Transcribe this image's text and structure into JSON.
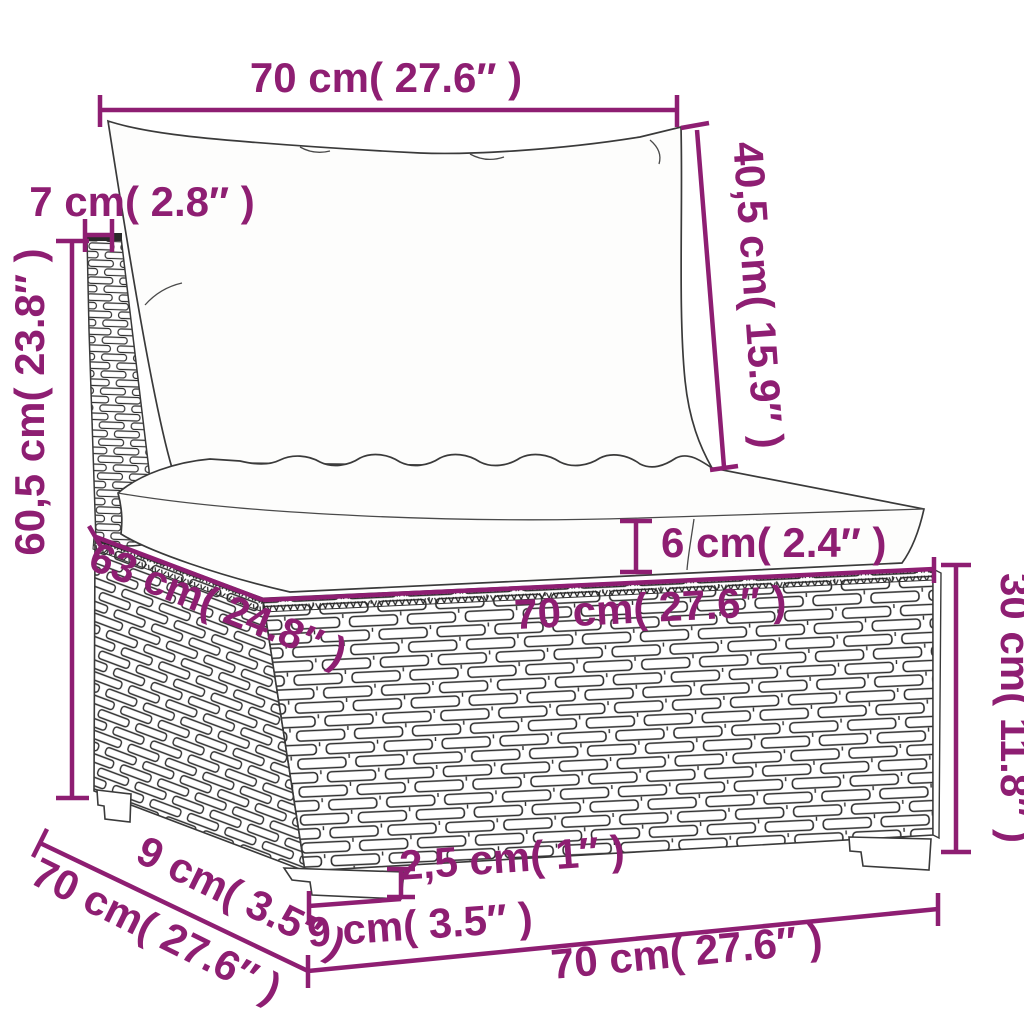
{
  "diagram": {
    "kind": "furniture-dimension-diagram",
    "subject": "poly rattan middle sofa section with back and seat cushions",
    "style": {
      "accent_color": "#8e1e72",
      "line_color": "#3a3a3a",
      "background": "#ffffff"
    },
    "labels": {
      "top_width": "70 cm( 27.6″ )",
      "back_cushion_height": "40,5 cm( 15.9″ )",
      "panel_thickness": "7 cm( 2.8″ )",
      "total_height": "60,5 cm( 23.8″ )",
      "seat_cushion_thickness": "6 cm( 2.4″ )",
      "seat_depth": "63 cm( 24.8″ )",
      "seat_front_width": "70 cm( 27.6″ )",
      "base_height": "30 cm( 11.8″ )",
      "foot_height": "2,5 cm( 1″ )",
      "front_foot_width": "9 cm( 3.5″ )",
      "side_foot_inset": "9 cm( 3.5″ )",
      "side_depth": "70 cm( 27.6″ )",
      "bottom_front_width": "70 cm( 27.6″ )"
    }
  }
}
